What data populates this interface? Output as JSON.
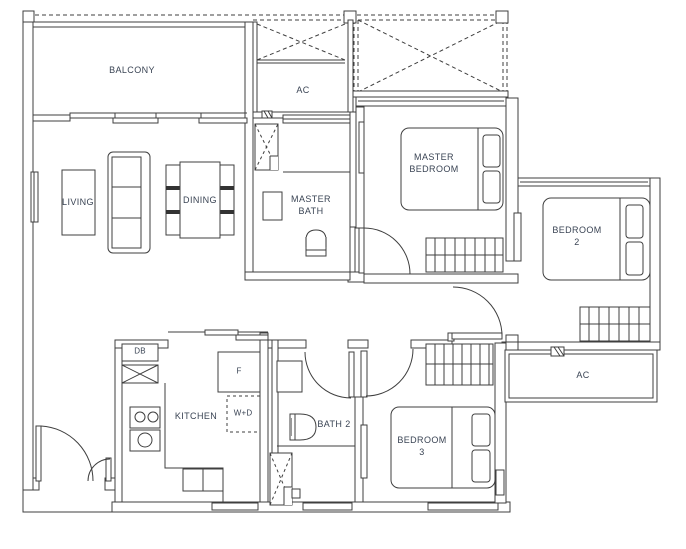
{
  "title": "2-bedroom-unit-floor-plan",
  "colors": {
    "line": "#3f3f3f",
    "label": "#3a4454"
  },
  "rooms": [
    {
      "id": "balcony",
      "label": "BALCONY"
    },
    {
      "id": "ac-upper",
      "label": "AC"
    },
    {
      "id": "living",
      "label": "LIVING"
    },
    {
      "id": "dining",
      "label": "DINING"
    },
    {
      "id": "master-bath",
      "label": "MASTER\nBATH"
    },
    {
      "id": "master-bedroom",
      "label": "MASTER\nBEDROOM"
    },
    {
      "id": "bedroom-2",
      "label": "BEDROOM\n2"
    },
    {
      "id": "kitchen",
      "label": "KITCHEN"
    },
    {
      "id": "bath-2",
      "label": "BATH 2"
    },
    {
      "id": "bedroom-3",
      "label": "BEDROOM\n3"
    },
    {
      "id": "ac-lower",
      "label": "AC"
    }
  ],
  "fixtures": [
    {
      "id": "db",
      "label": "DB"
    },
    {
      "id": "fridge",
      "label": "F"
    },
    {
      "id": "washer-dryer",
      "label": "W+D"
    }
  ]
}
